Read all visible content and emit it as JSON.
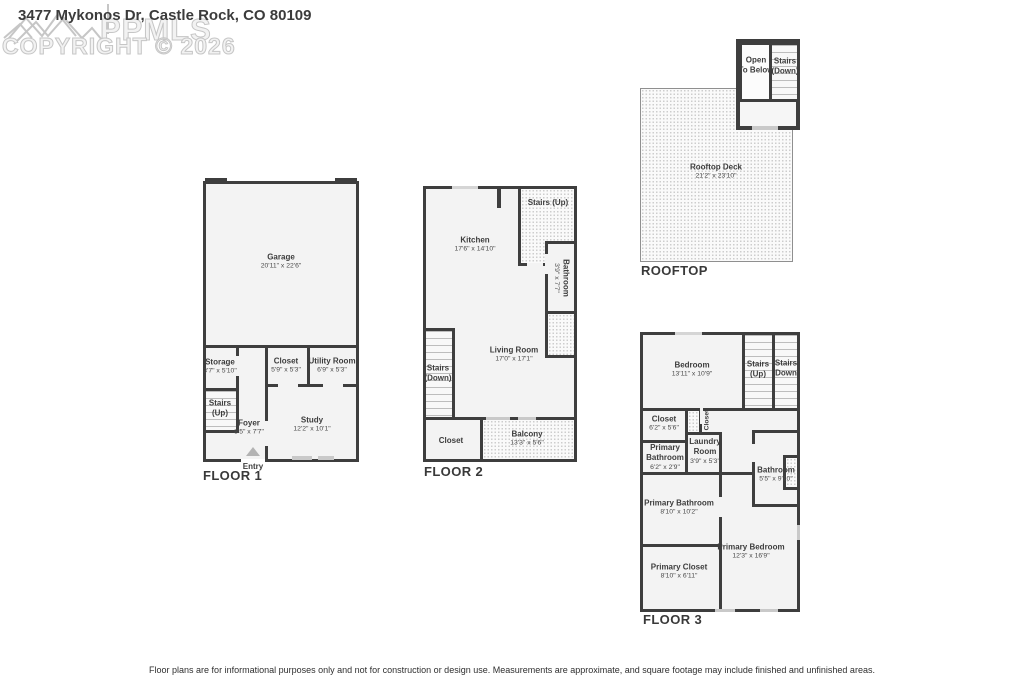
{
  "title": "3477 Mykonos Dr, Castle Rock, CO 80109",
  "watermark": {
    "logo": "mountain-logo",
    "brand": "PPMLS",
    "copyright": "COPYRIGHT © 2026"
  },
  "colors": {
    "wall": "#3e3e3e",
    "room_fill": "#f3f3f3",
    "watermark_outline": "#c6c6c6"
  },
  "floors": {
    "floor1": {
      "label": "FLOOR 1",
      "entry": "Entry",
      "garage": {
        "name": "Garage",
        "dims": "20'11\" x 22'6\""
      },
      "storage": {
        "name": "Storage",
        "dims": "3'7\" x 5'10\""
      },
      "stairs_up": {
        "name": "Stairs",
        "sub": "(Up)"
      },
      "closet": {
        "name": "Closet",
        "dims": "5'9\" x 5'3\""
      },
      "utility": {
        "name": "Utility Room",
        "dims": "6'9\" x 5'3\""
      },
      "foyer": {
        "name": "Foyer",
        "dims": "8'5\" x 7'7\""
      },
      "study": {
        "name": "Study",
        "dims": "12'2\" x 10'1\""
      }
    },
    "floor2": {
      "label": "FLOOR 2",
      "kitchen": {
        "name": "Kitchen",
        "dims": "17'6\" x 14'10\""
      },
      "stairs_up": {
        "name": "Stairs (Up)"
      },
      "bathroom": {
        "name": "Bathroom",
        "dims": "3'9\" x 7'7\""
      },
      "living": {
        "name": "Living Room",
        "dims": "17'0\" x 17'1\""
      },
      "stairs_down": {
        "name": "Stairs",
        "sub": "(Down)"
      },
      "closet": {
        "name": "Closet"
      },
      "balcony": {
        "name": "Balcony",
        "dims": "13'3\" x 5'6\""
      }
    },
    "rooftop": {
      "label": "ROOFTOP",
      "open_below": {
        "name": "Open",
        "sub": "To Below"
      },
      "stairs_down": {
        "name": "Stairs",
        "sub": "(Down)"
      },
      "deck": {
        "name": "Rooftop Deck",
        "dims": "21'2\" x 23'10\""
      }
    },
    "floor3": {
      "label": "FLOOR 3",
      "bedroom": {
        "name": "Bedroom",
        "dims": "13'11\" x 10'9\""
      },
      "stairs_up": {
        "name": "Stairs",
        "sub": "(Up)"
      },
      "stairs_down": {
        "name": "Stairs",
        "sub": "(Down)"
      },
      "closet": {
        "name": "Closet",
        "dims": "6'2\" x 5'6\""
      },
      "closet2": {
        "name": "Closet"
      },
      "laundry": {
        "name": "Laundry Room",
        "dims": "3'9\" x 5'3\""
      },
      "primary_bath_small": {
        "name": "Primary Bathroom",
        "dims": "6'2\" x 2'9\""
      },
      "bathroom": {
        "name": "Bathroom",
        "dims": "5'5\" x 9'10\""
      },
      "primary_bathroom": {
        "name": "Primary Bathroom",
        "dims": "8'10\" x 10'2\""
      },
      "primary_closet": {
        "name": "Primary Closet",
        "dims": "8'10\" x 6'11\""
      },
      "primary_bedroom": {
        "name": "Primary Bedroom",
        "dims": "12'3\" x 16'9\""
      }
    }
  },
  "disclaimer": "Floor plans are for informational purposes only and not for construction or design use. Measurements are approximate, and square footage may include finished and unfinished areas."
}
